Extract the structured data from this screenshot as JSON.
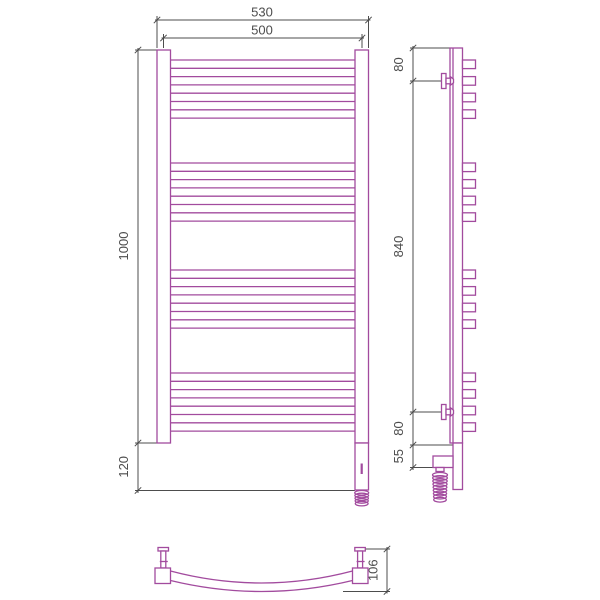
{
  "dimensions": {
    "front": {
      "width_outer": "530",
      "width_inner": "500",
      "height": "1000",
      "bottom_extension": "120"
    },
    "side": {
      "top_to_bracket": "80",
      "bracket_span": "840",
      "bracket_to_bottom": "80",
      "bottom_section": "55"
    },
    "bottom": {
      "bar_depth": "106"
    }
  },
  "colors": {
    "body": "#a24b9e",
    "dimension": "#4d4d4d",
    "background": "#ffffff"
  },
  "geometry": {
    "bar_group_tops": [
      60,
      163,
      270,
      373
    ],
    "bars_per_group": 8,
    "bar_pitch": 8.3,
    "stubs_per_group": 4,
    "stub_pitch": 16.6
  }
}
